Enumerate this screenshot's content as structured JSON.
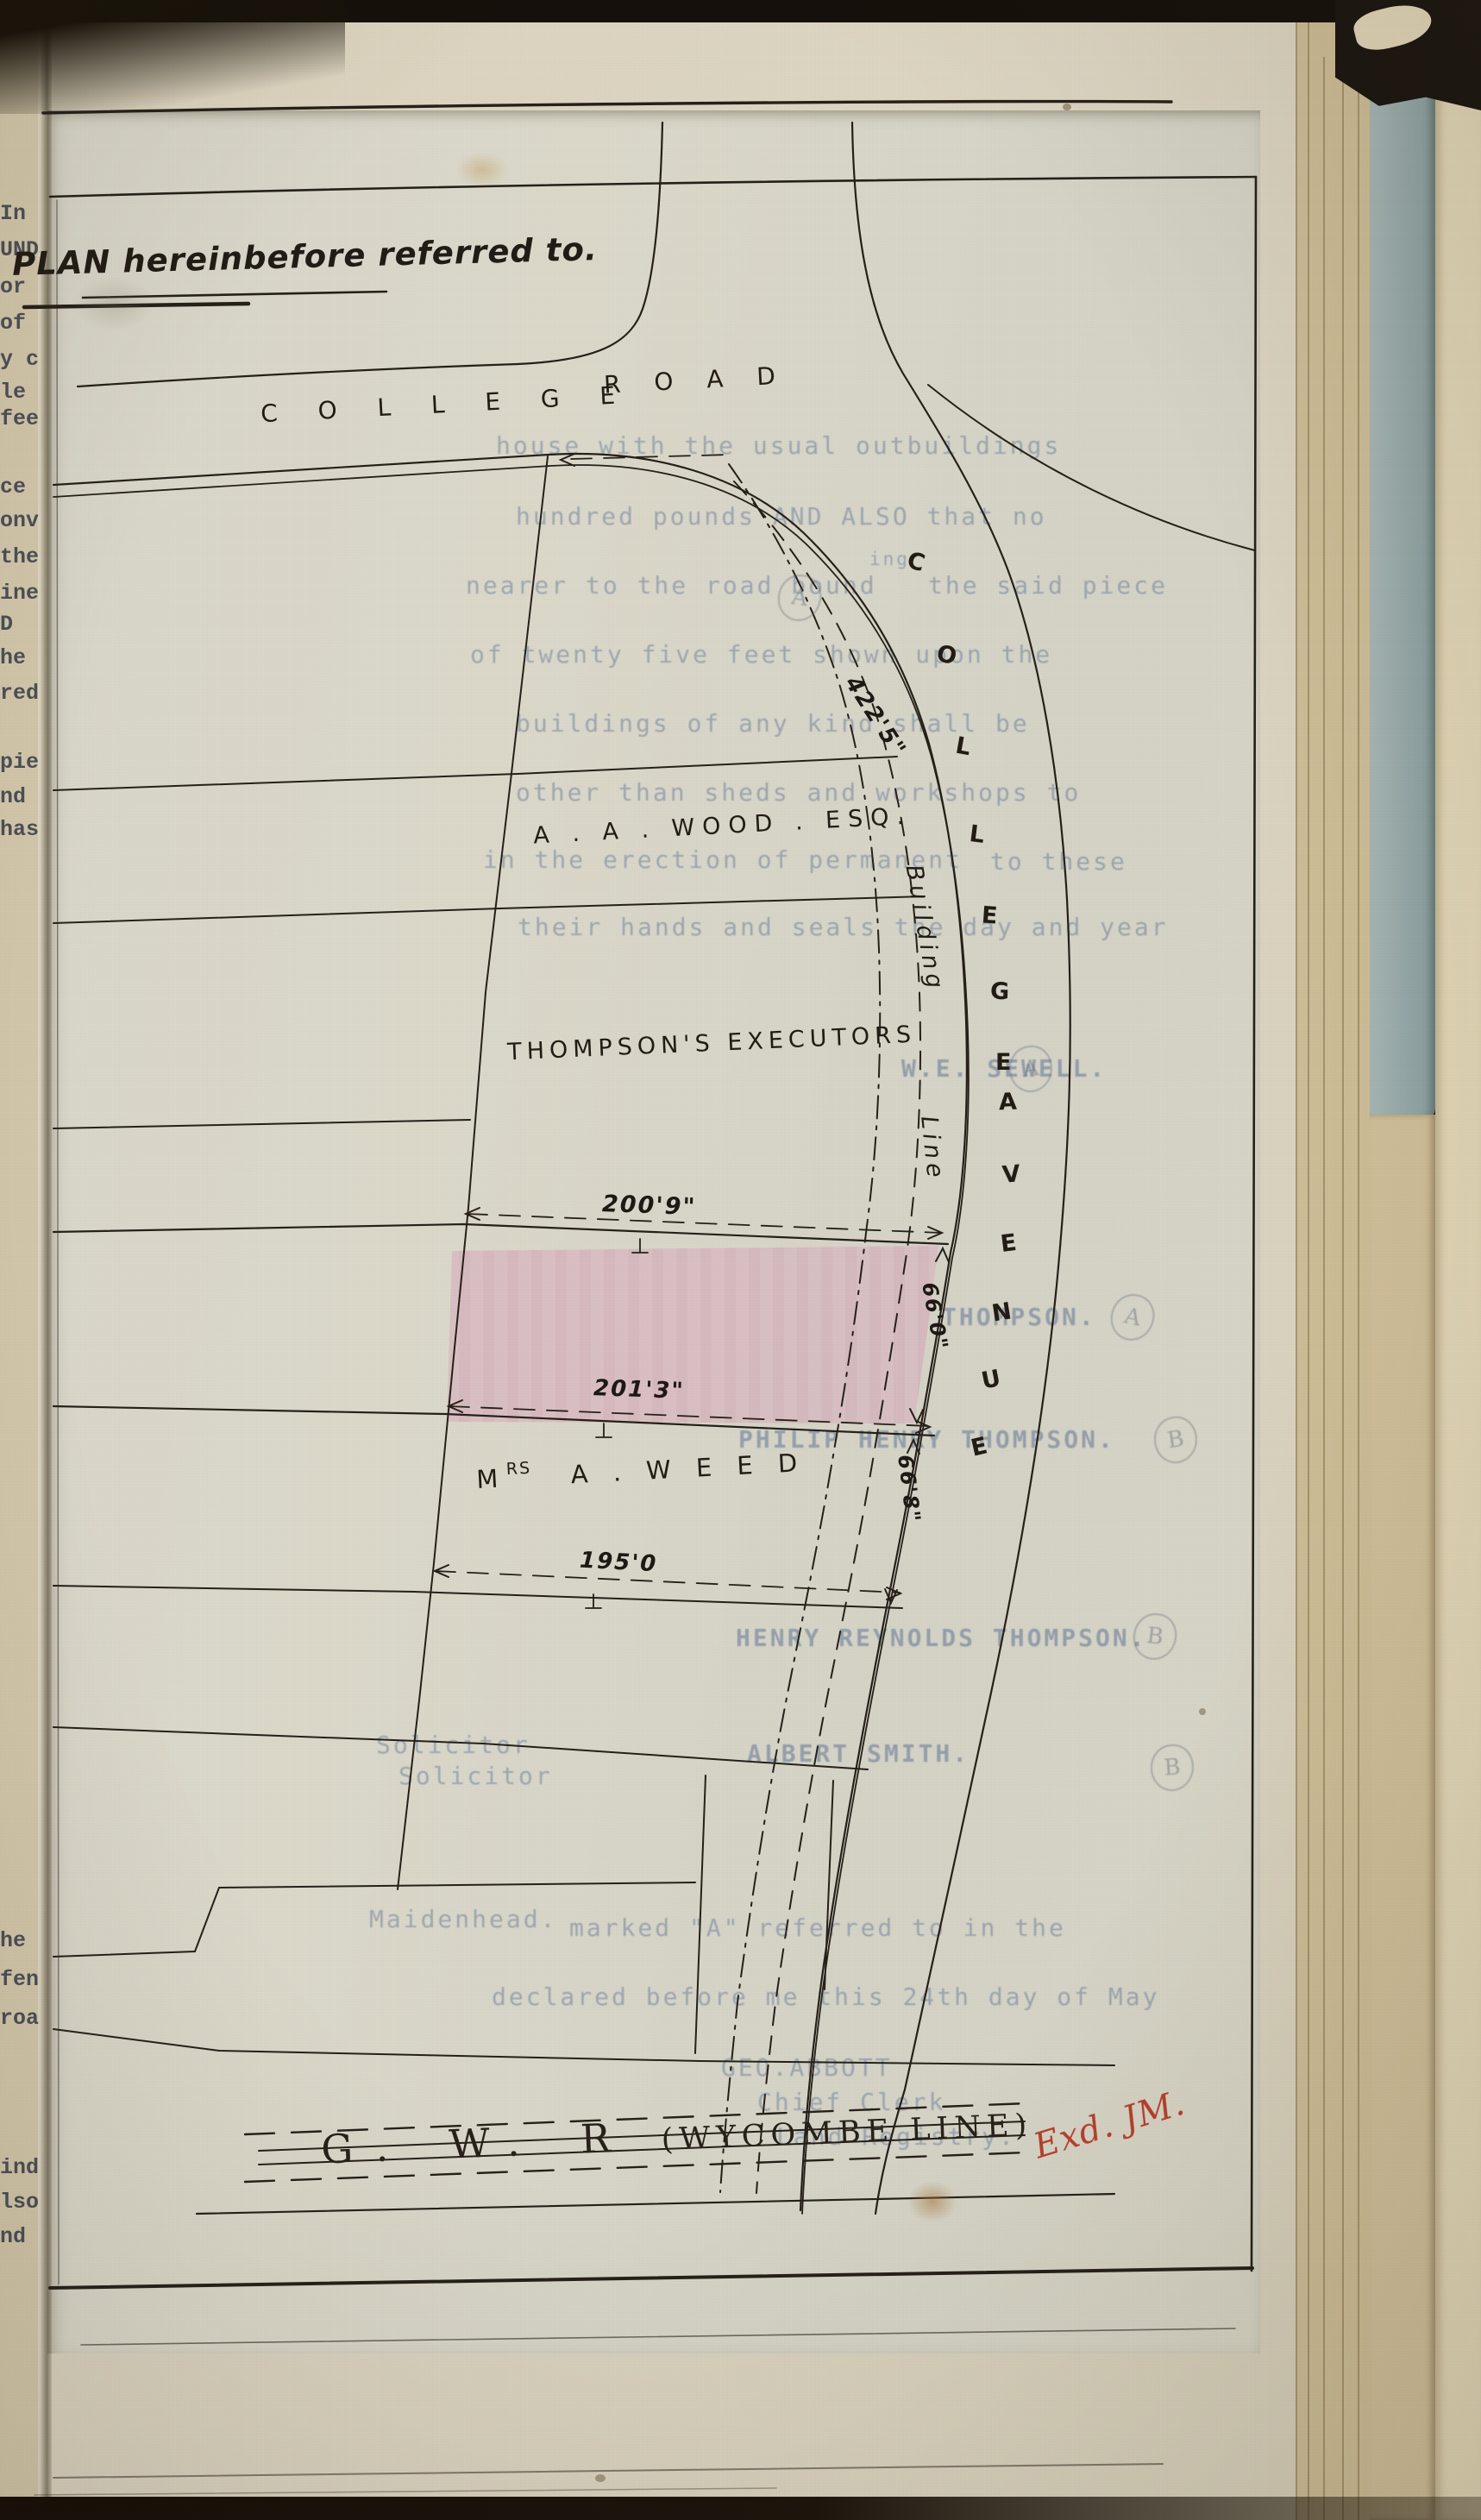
{
  "title": "PLAN hereinbefore referred to.",
  "plan": {
    "road_name_1": "C O L L E G E",
    "road_name_2": "R O A D",
    "avenue_word1": [
      "C",
      "O",
      "L",
      "L",
      "E",
      "G",
      "E"
    ],
    "avenue_word2": [
      "A",
      "V",
      "E",
      "N",
      "U",
      "E"
    ],
    "building_line_word1": "Building",
    "building_line_word2": "Line",
    "plot_owner_1": "A . A . WOOD .  ESQ.",
    "plot_owner_2": "THOMPSON'S   EXECUTORS",
    "plot_owner_3_prefix": "M",
    "plot_owner_3_sup": "RS",
    "plot_owner_3_name": "A .   W E E D",
    "dim_frontage": "422'5\"",
    "dim_pink_top": "200'9\"",
    "dim_pink_bottom": "201'3\"",
    "dim_weed": "195'0",
    "dim_pink_side": "66'0\"",
    "dim_weed_side": "66'8\"",
    "railway_initials": "G. W. R",
    "railway_name": "(WYCOMBE  LINE)",
    "examined_mark": "Exd. JM."
  },
  "ghost_text": {
    "para": [
      "house with the usual outbuildings",
      "hundred pounds AND ALSO that no",
      "nearer to the road bound",
      "ing",
      "the said piece",
      "of twenty five feet shown upon the",
      "buildings of any kind shall be",
      "other than sheds and workshops to",
      "in the erection of permanent",
      "to these",
      "their hands and seals the day and year"
    ],
    "names": [
      "W.E. SEWELL.",
      "THOMPSON.",
      "PHILIP HENRY THOMPSON.",
      "HENRY REYNOLDS THOMPSON.",
      "ALBERT SMITH."
    ],
    "solicitor": [
      "Solicitor",
      "Solicitor",
      "Maidenhead."
    ],
    "attestation": [
      "marked \"A\" referred to in the",
      "declared before me this 24th day of May",
      "GEO.ABBOTT",
      "Chief Clerk",
      "Land Registry."
    ]
  },
  "margin_fragments": [
    "In",
    "UNDS",
    "or",
    "of t",
    "y co",
    "le",
    "feet",
    "ce o",
    "onve",
    "the",
    "ine",
    "D",
    "he",
    "red",
    "pie",
    "nd",
    "hase",
    "he s",
    "fen",
    "road",
    "ind",
    "lso",
    "nd"
  ],
  "pencil_marks": [
    "A",
    "A",
    "A",
    "B",
    "B",
    "B"
  ],
  "colors": {
    "plot_highlight": "#d9b9c1",
    "stamp_red": "#b5402c",
    "ghost_blue": "#6c80a0",
    "paper": "#d9d5c6",
    "board_blue": "#9fb1b1",
    "ink": "#262019"
  }
}
